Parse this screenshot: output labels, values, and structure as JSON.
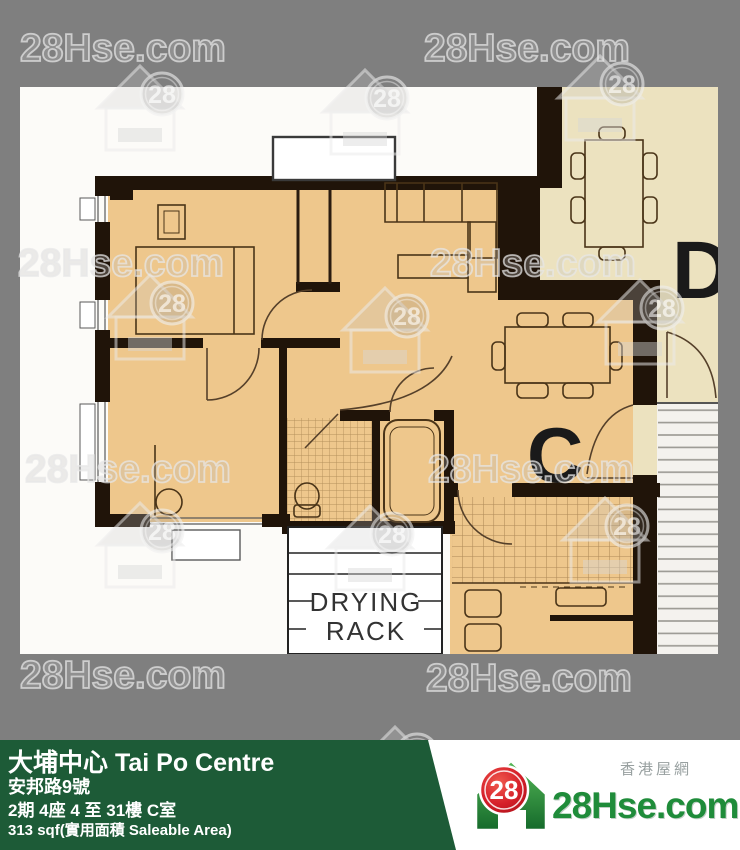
{
  "watermark": {
    "text": "28Hse.com",
    "logo_number": "28"
  },
  "floorplan": {
    "unit_label_c": "C",
    "unit_label_d": "D",
    "drying_rack_line1": "DRYING",
    "drying_rack_line2": "RACK",
    "colors": {
      "unit_fill": "#eec78c",
      "neighbor_fill": "#ece2bf",
      "wall": "#201409",
      "hatch": "#8d6a3a",
      "stairs_fill": "#f4f2ee"
    }
  },
  "footer": {
    "title": "大埔中心 Tai Po Centre",
    "address": "安邦路9號",
    "floor_info": "2期 4座 4 至 31樓 C室",
    "area_info": "313 sqf(實用面積 Saleable Area)",
    "bar_color": "#1d5b37",
    "brand": {
      "number": "28",
      "name": "28Hse.com",
      "tagline_cn": "香港屋網",
      "green": "#1f8c3a",
      "red": "#d6202a"
    }
  }
}
